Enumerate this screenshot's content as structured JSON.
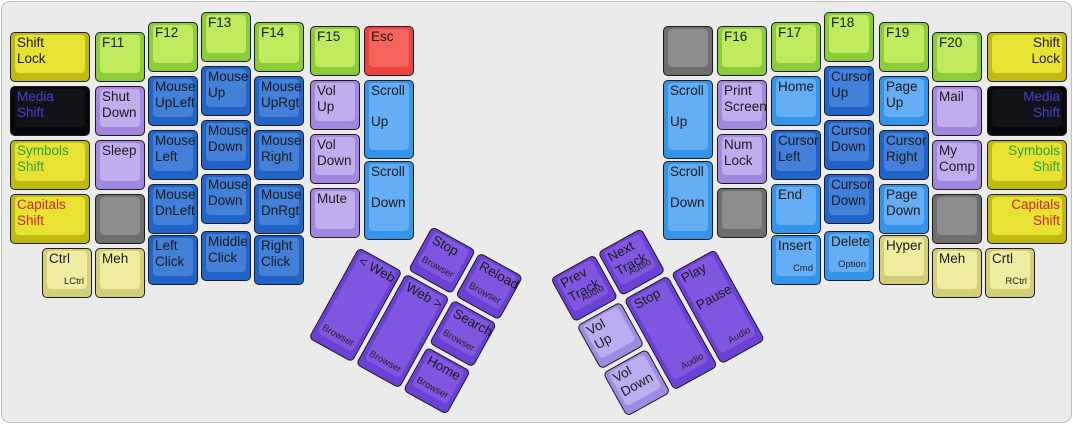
{
  "palette": {
    "case_bg": "#ebebeb",
    "case_border": "#bdbdbd",
    "colors": {
      "green": {
        "base": "#8ccb3a",
        "top": "#c0eb5e"
      },
      "yellow": {
        "base": "#c0ba10",
        "top": "#e8e333"
      },
      "black": {
        "base": "#070709",
        "top": "#111118"
      },
      "purple": {
        "base": "#a188de",
        "top": "#c1adee"
      },
      "blue": {
        "base": "#2163c7",
        "top": "#4280da"
      },
      "lblue": {
        "base": "#3494e9",
        "top": "#65adf4"
      },
      "red": {
        "base": "#ee4141",
        "top": "#f4635c"
      },
      "gray": {
        "base": "#6e6e6e",
        "top": "#8c8c8c"
      },
      "cream": {
        "base": "#d3cf7a",
        "top": "#f0eda0"
      },
      "violet": {
        "base": "#6b40d5",
        "top": "#8157e2"
      },
      "lviolet": {
        "base": "#a18ae2",
        "top": "#bdadf0"
      }
    },
    "text": {
      "default": "#1a1a1a",
      "media": "#4343cf",
      "symbols": "#2f9e3c",
      "capitals": "#cc2727"
    }
  },
  "keys": [
    {
      "name": "shift-lock-left",
      "lines": [
        "Shift",
        "Lock"
      ],
      "color": "yellow",
      "x": 8,
      "y": 30,
      "w": 80,
      "h": 50
    },
    {
      "name": "media-shift-left",
      "lines": [
        "Media",
        "Shift"
      ],
      "color": "black",
      "text": "media",
      "x": 8,
      "y": 84,
      "w": 80,
      "h": 50
    },
    {
      "name": "symbols-shift-left",
      "lines": [
        "Symbols",
        "Shift"
      ],
      "color": "yellow",
      "text": "symbols",
      "x": 8,
      "y": 138,
      "w": 80,
      "h": 50
    },
    {
      "name": "capitals-shift-left",
      "lines": [
        "Capitals",
        "Shift"
      ],
      "color": "yellow",
      "text": "capitals",
      "x": 8,
      "y": 192,
      "w": 80,
      "h": 50
    },
    {
      "name": "f11",
      "lines": [
        "F11"
      ],
      "color": "green",
      "x": 93,
      "y": 30,
      "w": 50,
      "h": 50
    },
    {
      "name": "shut-down",
      "lines": [
        "Shut",
        "Down"
      ],
      "color": "purple",
      "x": 93,
      "y": 84,
      "w": 50,
      "h": 50
    },
    {
      "name": "sleep",
      "lines": [
        "Sleep"
      ],
      "color": "purple",
      "x": 93,
      "y": 138,
      "w": 50,
      "h": 50
    },
    {
      "name": "blank-left-1",
      "lines": [],
      "color": "gray",
      "x": 93,
      "y": 192,
      "w": 50,
      "h": 50
    },
    {
      "name": "ctrl-left",
      "lines": [
        "Ctrl"
      ],
      "sub": "LCtrl",
      "color": "cream",
      "x": 40,
      "y": 246,
      "w": 50,
      "h": 50
    },
    {
      "name": "meh-left",
      "lines": [
        "Meh"
      ],
      "color": "cream",
      "x": 93,
      "y": 246,
      "w": 50,
      "h": 50
    },
    {
      "name": "f12",
      "lines": [
        "F12"
      ],
      "color": "green",
      "x": 146,
      "y": 20,
      "w": 50,
      "h": 50
    },
    {
      "name": "mouse-upleft",
      "lines": [
        "Mouse",
        "UpLeft"
      ],
      "color": "blue",
      "x": 146,
      "y": 74,
      "w": 50,
      "h": 50
    },
    {
      "name": "mouse-left",
      "lines": [
        "Mouse",
        "Left"
      ],
      "color": "blue",
      "x": 146,
      "y": 128,
      "w": 50,
      "h": 50
    },
    {
      "name": "mouse-dnleft",
      "lines": [
        "Mouse",
        "DnLeft"
      ],
      "color": "blue",
      "x": 146,
      "y": 182,
      "w": 50,
      "h": 50
    },
    {
      "name": "left-click",
      "lines": [
        "Left",
        "Click"
      ],
      "color": "blue",
      "x": 146,
      "y": 233,
      "w": 50,
      "h": 50
    },
    {
      "name": "f13",
      "lines": [
        "F13"
      ],
      "color": "green",
      "x": 199,
      "y": 10,
      "w": 50,
      "h": 50
    },
    {
      "name": "mouse-up",
      "lines": [
        "Mouse",
        "Up"
      ],
      "color": "blue",
      "x": 199,
      "y": 64,
      "w": 50,
      "h": 50
    },
    {
      "name": "mouse-down-1",
      "lines": [
        "Mouse",
        "Down"
      ],
      "color": "blue",
      "x": 199,
      "y": 118,
      "w": 50,
      "h": 50
    },
    {
      "name": "mouse-down-2",
      "lines": [
        "Mouse",
        "Down"
      ],
      "color": "blue",
      "x": 199,
      "y": 172,
      "w": 50,
      "h": 50
    },
    {
      "name": "middle-click",
      "lines": [
        "Middle",
        "Click"
      ],
      "color": "blue",
      "x": 199,
      "y": 229,
      "w": 50,
      "h": 50
    },
    {
      "name": "f14",
      "lines": [
        "F14"
      ],
      "color": "green",
      "x": 252,
      "y": 20,
      "w": 50,
      "h": 50
    },
    {
      "name": "mouse-uprgt",
      "lines": [
        "Mouse",
        "UpRgt"
      ],
      "color": "blue",
      "x": 252,
      "y": 74,
      "w": 50,
      "h": 50
    },
    {
      "name": "mouse-right",
      "lines": [
        "Mouse",
        "Right"
      ],
      "color": "blue",
      "x": 252,
      "y": 128,
      "w": 50,
      "h": 50
    },
    {
      "name": "mouse-dnrgt",
      "lines": [
        "Mouse",
        "DnRgt"
      ],
      "color": "blue",
      "x": 252,
      "y": 182,
      "w": 50,
      "h": 50
    },
    {
      "name": "right-click",
      "lines": [
        "Right",
        "Click"
      ],
      "color": "blue",
      "x": 252,
      "y": 233,
      "w": 50,
      "h": 50
    },
    {
      "name": "f15",
      "lines": [
        "F15"
      ],
      "color": "green",
      "x": 308,
      "y": 24,
      "w": 50,
      "h": 50
    },
    {
      "name": "vol-up-left",
      "lines": [
        "Vol",
        "Up"
      ],
      "color": "purple",
      "x": 308,
      "y": 78,
      "w": 50,
      "h": 50
    },
    {
      "name": "vol-down-left",
      "lines": [
        "Vol",
        "Down"
      ],
      "color": "purple",
      "x": 308,
      "y": 132,
      "w": 50,
      "h": 50
    },
    {
      "name": "mute",
      "lines": [
        "Mute"
      ],
      "color": "purple",
      "x": 308,
      "y": 186,
      "w": 50,
      "h": 50
    },
    {
      "name": "esc",
      "lines": [
        "Esc"
      ],
      "color": "red",
      "x": 362,
      "y": 24,
      "w": 50,
      "h": 50
    },
    {
      "name": "scroll-up-left",
      "lines": [
        "Scroll",
        "",
        "Up"
      ],
      "color": "lblue",
      "x": 362,
      "y": 78,
      "w": 50,
      "h": 79
    },
    {
      "name": "scroll-down-left",
      "lines": [
        "Scroll",
        "",
        "Down"
      ],
      "color": "lblue",
      "x": 362,
      "y": 159,
      "w": 50,
      "h": 79
    },
    {
      "name": "blank-right-1",
      "lines": [],
      "color": "gray",
      "x": 661,
      "y": 24,
      "w": 50,
      "h": 50
    },
    {
      "name": "scroll-up-right",
      "lines": [
        "Scroll",
        "",
        "Up"
      ],
      "color": "lblue",
      "x": 661,
      "y": 78,
      "w": 50,
      "h": 79
    },
    {
      "name": "scroll-down-right",
      "lines": [
        "Scroll",
        "",
        "Down"
      ],
      "color": "lblue",
      "x": 661,
      "y": 159,
      "w": 50,
      "h": 79
    },
    {
      "name": "f16",
      "lines": [
        "F16"
      ],
      "color": "green",
      "x": 715,
      "y": 24,
      "w": 50,
      "h": 50
    },
    {
      "name": "print-screen",
      "lines": [
        "Print",
        "Screen"
      ],
      "color": "purple",
      "x": 715,
      "y": 78,
      "w": 50,
      "h": 50
    },
    {
      "name": "num-lock",
      "lines": [
        "Num",
        "Lock"
      ],
      "color": "purple",
      "x": 715,
      "y": 132,
      "w": 50,
      "h": 50
    },
    {
      "name": "blank-right-2",
      "lines": [],
      "color": "gray",
      "x": 715,
      "y": 186,
      "w": 50,
      "h": 50
    },
    {
      "name": "f17",
      "lines": [
        "F17"
      ],
      "color": "green",
      "x": 769,
      "y": 20,
      "w": 50,
      "h": 50
    },
    {
      "name": "nav-home",
      "lines": [
        "Home"
      ],
      "color": "lblue",
      "x": 769,
      "y": 74,
      "w": 50,
      "h": 50
    },
    {
      "name": "cursor-left",
      "lines": [
        "Cursor",
        "Left"
      ],
      "color": "blue",
      "x": 769,
      "y": 128,
      "w": 50,
      "h": 50
    },
    {
      "name": "end",
      "lines": [
        "End"
      ],
      "color": "lblue",
      "x": 769,
      "y": 182,
      "w": 50,
      "h": 50
    },
    {
      "name": "insert",
      "lines": [
        "Insert"
      ],
      "sub": "Cmd",
      "color": "lblue",
      "x": 769,
      "y": 233,
      "w": 50,
      "h": 50
    },
    {
      "name": "f18",
      "lines": [
        "F18"
      ],
      "color": "green",
      "x": 822,
      "y": 10,
      "w": 50,
      "h": 50
    },
    {
      "name": "cursor-up",
      "lines": [
        "Cursor",
        "Up"
      ],
      "color": "blue",
      "x": 822,
      "y": 64,
      "w": 50,
      "h": 50
    },
    {
      "name": "cursor-down-1",
      "lines": [
        "Cursor",
        "Down"
      ],
      "color": "blue",
      "x": 822,
      "y": 118,
      "w": 50,
      "h": 50
    },
    {
      "name": "cursor-down-2",
      "lines": [
        "Cursor",
        "Down"
      ],
      "color": "blue",
      "x": 822,
      "y": 172,
      "w": 50,
      "h": 50
    },
    {
      "name": "delete",
      "lines": [
        "Delete"
      ],
      "sub": "Option",
      "color": "lblue",
      "x": 822,
      "y": 229,
      "w": 50,
      "h": 50
    },
    {
      "name": "f19",
      "lines": [
        "F19"
      ],
      "color": "green",
      "x": 877,
      "y": 20,
      "w": 50,
      "h": 50
    },
    {
      "name": "page-up",
      "lines": [
        "Page",
        "Up"
      ],
      "color": "lblue",
      "x": 877,
      "y": 74,
      "w": 50,
      "h": 50
    },
    {
      "name": "cursor-right",
      "lines": [
        "Cursor",
        "Right"
      ],
      "color": "blue",
      "x": 877,
      "y": 128,
      "w": 50,
      "h": 50
    },
    {
      "name": "page-down",
      "lines": [
        "Page",
        "Down"
      ],
      "color": "lblue",
      "x": 877,
      "y": 182,
      "w": 50,
      "h": 50
    },
    {
      "name": "hyper",
      "lines": [
        "Hyper"
      ],
      "color": "cream",
      "x": 877,
      "y": 233,
      "w": 50,
      "h": 50
    },
    {
      "name": "f20",
      "lines": [
        "F20"
      ],
      "color": "green",
      "x": 930,
      "y": 30,
      "w": 50,
      "h": 50
    },
    {
      "name": "mail",
      "lines": [
        "Mail"
      ],
      "color": "purple",
      "x": 930,
      "y": 84,
      "w": 50,
      "h": 50
    },
    {
      "name": "my-comp",
      "lines": [
        "My",
        "Comp"
      ],
      "color": "purple",
      "x": 930,
      "y": 138,
      "w": 50,
      "h": 50
    },
    {
      "name": "blank-right-3",
      "lines": [],
      "color": "gray",
      "x": 930,
      "y": 192,
      "w": 50,
      "h": 50
    },
    {
      "name": "meh-right",
      "lines": [
        "Meh"
      ],
      "color": "cream",
      "x": 930,
      "y": 246,
      "w": 50,
      "h": 50
    },
    {
      "name": "shift-lock-right",
      "lines": [
        "Shift",
        "Lock"
      ],
      "align": "right",
      "color": "yellow",
      "x": 985,
      "y": 30,
      "w": 80,
      "h": 50
    },
    {
      "name": "media-shift-right",
      "lines": [
        "Media",
        "Shift"
      ],
      "align": "right",
      "color": "black",
      "text": "media",
      "x": 985,
      "y": 84,
      "w": 80,
      "h": 50
    },
    {
      "name": "symbols-shift-right",
      "lines": [
        "Symbols",
        "Shift"
      ],
      "align": "right",
      "color": "yellow",
      "text": "symbols",
      "x": 985,
      "y": 138,
      "w": 80,
      "h": 50
    },
    {
      "name": "capitals-shift-right",
      "lines": [
        "Capitals",
        "Shift"
      ],
      "align": "right",
      "color": "yellow",
      "text": "capitals",
      "x": 985,
      "y": 192,
      "w": 80,
      "h": 50
    },
    {
      "name": "crtl-right",
      "lines": [
        "Crtl"
      ],
      "sub": "RCtrl",
      "color": "cream",
      "x": 983,
      "y": 246,
      "w": 50,
      "h": 50
    }
  ],
  "thumb_left": {
    "x": 383,
    "y": 198,
    "rotation": 29,
    "origin": "0 0",
    "keys": [
      {
        "name": "browser-stop",
        "lines": [
          "Stop"
        ],
        "sub": "Browser",
        "color": "violet",
        "x": 54,
        "y": 0,
        "w": 50,
        "h": 50
      },
      {
        "name": "browser-reload",
        "lines": [
          "Reload"
        ],
        "sub": "Browser",
        "color": "violet",
        "x": 108,
        "y": 0,
        "w": 50,
        "h": 50
      },
      {
        "name": "web-back",
        "lines": [
          "< Web"
        ],
        "sub": "Browser",
        "color": "violet",
        "x": 0,
        "y": 54,
        "w": 50,
        "h": 104
      },
      {
        "name": "web-forward",
        "lines": [
          "Web >"
        ],
        "sub": "Browser",
        "color": "violet",
        "x": 54,
        "y": 54,
        "w": 50,
        "h": 104
      },
      {
        "name": "browser-search",
        "lines": [
          "Search"
        ],
        "sub": "Browser",
        "color": "violet",
        "x": 108,
        "y": 54,
        "w": 50,
        "h": 50
      },
      {
        "name": "browser-home",
        "lines": [
          "Home"
        ],
        "sub": "Browser",
        "color": "violet",
        "x": 108,
        "y": 108,
        "w": 50,
        "h": 50
      }
    ]
  },
  "thumb_right": {
    "x": 528,
    "y": 198,
    "rotation": -29,
    "origin": "100% 0",
    "keys": [
      {
        "name": "prev-track",
        "lines": [
          "Prev",
          "Track"
        ],
        "sub": "Audio",
        "color": "violet",
        "x": 0,
        "y": 0,
        "w": 50,
        "h": 50
      },
      {
        "name": "next-track",
        "lines": [
          "Next",
          "Track"
        ],
        "sub": "Audio",
        "color": "violet",
        "x": 54,
        "y": 0,
        "w": 50,
        "h": 50
      },
      {
        "name": "audio-vol-up",
        "lines": [
          "Vol",
          "Up"
        ],
        "color": "lviolet",
        "x": 0,
        "y": 54,
        "w": 50,
        "h": 50
      },
      {
        "name": "audio-stop",
        "lines": [
          "Stop"
        ],
        "sub": "Audio",
        "color": "violet",
        "x": 54,
        "y": 54,
        "w": 50,
        "h": 104
      },
      {
        "name": "play-pause",
        "lines": [
          "Play",
          "",
          "Pause"
        ],
        "sub": "Audio",
        "color": "violet",
        "x": 108,
        "y": 54,
        "w": 50,
        "h": 104
      },
      {
        "name": "audio-vol-down",
        "lines": [
          "Vol",
          "Down"
        ],
        "color": "lviolet",
        "x": 0,
        "y": 108,
        "w": 50,
        "h": 50
      }
    ]
  }
}
